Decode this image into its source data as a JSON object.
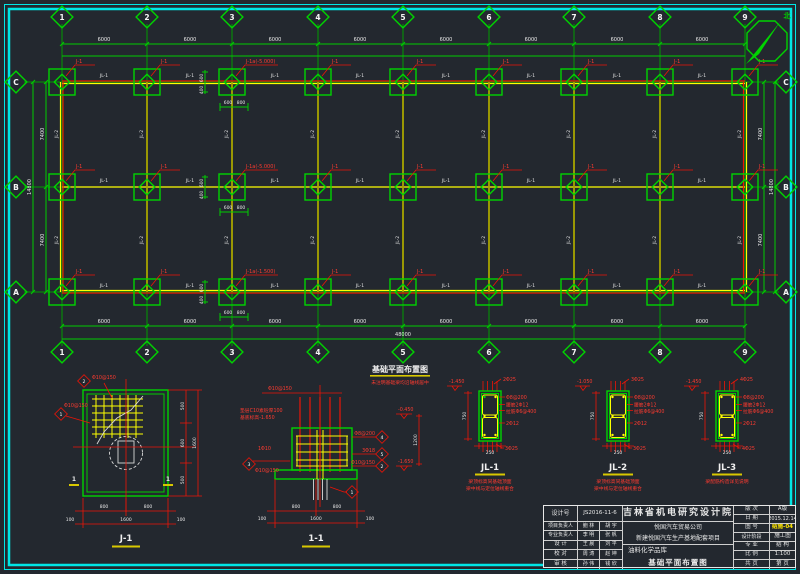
{
  "north": {
    "label": "北"
  },
  "plan": {
    "title": "基础平面布置图",
    "title_note": "未注明基础梁均沿轴线居中",
    "grid_cols": [
      "1",
      "2",
      "3",
      "4",
      "5",
      "6",
      "7",
      "8",
      "9"
    ],
    "grid_rows": [
      "C",
      "B",
      "A"
    ],
    "bay_dim": "6000",
    "total_dim": "48000",
    "row_dim": "7400",
    "row_total": "14800",
    "pad_label": "J-1",
    "pad_label_c3": "J-1a(-5.000)",
    "pad_label_b3": "J-1a(-5.000)",
    "pad_label_a3": "J-1a(-1.500)",
    "beam_h_label": "JL-1",
    "beam_v_label": "JL-2",
    "pad_dim_w1": "600",
    "pad_dim_w2": "800",
    "pad_dim_h1": "600",
    "pad_dim_h2": "400"
  },
  "detail_j1": {
    "name": "J-1",
    "section_mark": "1",
    "rebar_top": "Φ10@150",
    "rebar_left": "Φ10@150",
    "mark_top": "2",
    "mark_left": "1",
    "dim_b1": "800",
    "dim_b2": "800",
    "dim_b_total": "1600",
    "dim_stub": "100",
    "dim_r1": "500",
    "dim_r2": "600",
    "dim_r3": "500",
    "dim_r_total": "1600"
  },
  "detail_11": {
    "name": "1-1",
    "note_line1": "垫层C10素砼厚100",
    "note_line2": "基底标高-1.650",
    "top_rebar": "Φ10@150",
    "bar_label": "1Φ10",
    "callout_3": "Φ10@150",
    "callout_4": "Φ8@200",
    "callout_5": "3Φ18",
    "callout_2": "Φ10@150",
    "mark_1": "1",
    "mark_2": "2",
    "mark_3": "3",
    "mark_4": "4",
    "mark_5": "5",
    "elev_top": "-0.450",
    "elev_bottom": "-1.650",
    "height_dim": "1200",
    "dim_b1": "800",
    "dim_b2": "800",
    "dim_b_total": "1600",
    "dim_stub": "100"
  },
  "beam_sections": [
    {
      "name": "JL-1",
      "elevation": "-1.450",
      "top_bar": "2Φ25",
      "stirrup": "Φ8@200",
      "waist": "腰筋2Φ12",
      "tie": "拉筋Φ6@400",
      "side_bar": "2Φ12",
      "bottom_bar": "3Φ25",
      "width_dim": "250",
      "height_dim": "750",
      "note1": "梁顶标高同基础顶面",
      "note2": "梁中线与定位轴线重合"
    },
    {
      "name": "JL-2",
      "elevation": "-1.050",
      "top_bar": "3Φ25",
      "stirrup": "Φ8@200",
      "waist": "腰筋2Φ12",
      "tie": "拉筋Φ6@400",
      "side_bar": "2Φ12",
      "bottom_bar": "3Φ25",
      "width_dim": "250",
      "height_dim": "750",
      "note1": "梁顶标高同基础顶面",
      "note2": "梁中线与定位轴线重合"
    },
    {
      "name": "JL-3",
      "elevation": "-1.450",
      "top_bar": "4Φ25",
      "stirrup": "Φ8@200",
      "waist": "腰筋2Φ12",
      "tie": "拉筋Φ6@400",
      "side_bar": "2Φ12",
      "bottom_bar": "4Φ25",
      "width_dim": "250",
      "height_dim": "750",
      "note1": "梁配筋构造详见说明",
      "note2": ""
    }
  ],
  "titleblock": {
    "design_no_label": "设计号",
    "design_no": "JS2016-11-6",
    "staff": [
      {
        "label": "项目负责人",
        "a": "鲍 林",
        "b": "胡 宇"
      },
      {
        "label": "专业负责人",
        "a": "李 明",
        "b": "张 帆"
      },
      {
        "label": "设 计",
        "a": "王 晨",
        "b": "刘 平"
      },
      {
        "label": "校 对",
        "a": "周 涛",
        "b": "赵 坤"
      },
      {
        "label": "审 核",
        "a": "孙 伟",
        "b": "钱 欣"
      }
    ],
    "institute": "吉林省机电研究设计院",
    "client": "悦国汽车贸易公司",
    "project": "新建悦国汽车生产基地配套项目",
    "subproject": "油料化学品库",
    "drawing_name": "基础平面布置图",
    "info": [
      {
        "label": "版 次",
        "value": "A版"
      },
      {
        "label": "日 期",
        "value": "2015.12.14"
      },
      {
        "label": "图 号",
        "value": "结施-04"
      },
      {
        "label": "设计阶段",
        "value": "施工图"
      },
      {
        "label": "专 业",
        "value": "结 构"
      },
      {
        "label": "比 例",
        "value": "1:100"
      },
      {
        "label": "共 页",
        "value": "第 页"
      }
    ]
  }
}
